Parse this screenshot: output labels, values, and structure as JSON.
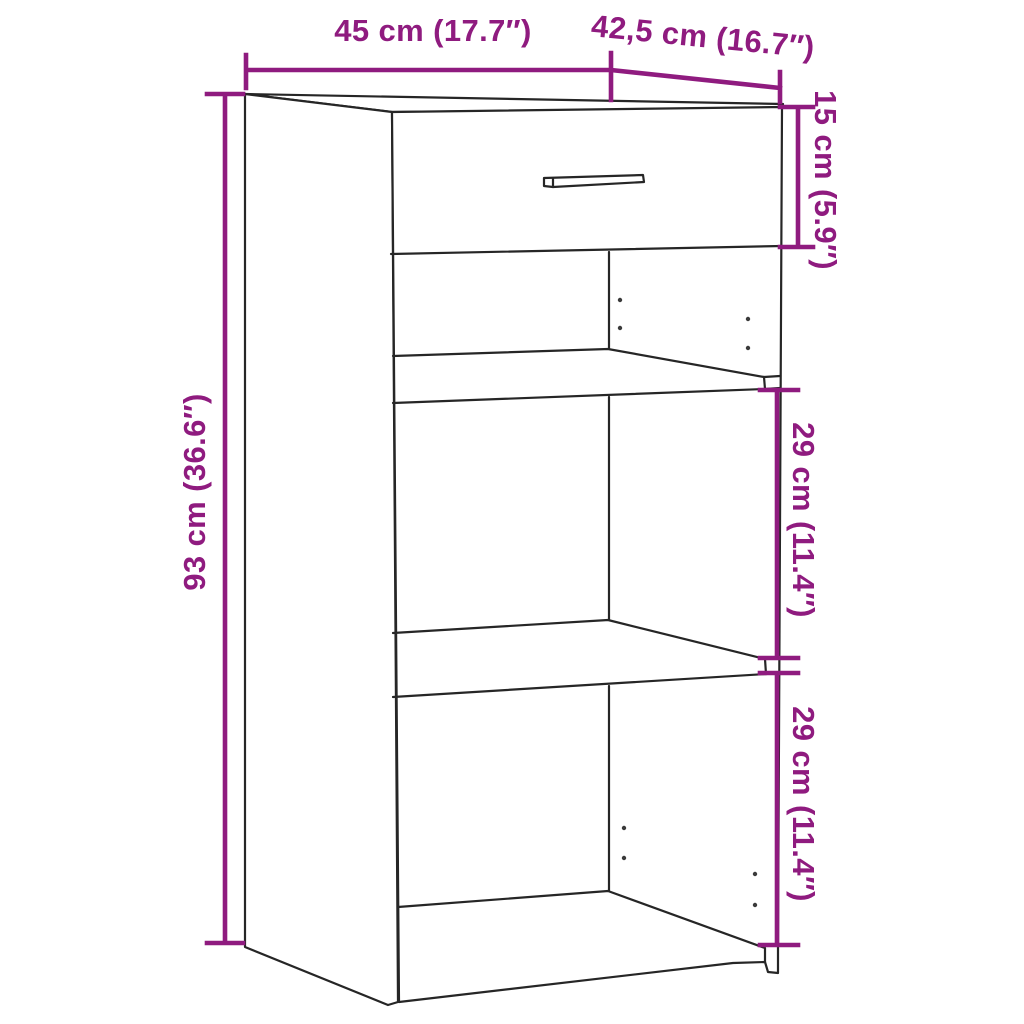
{
  "diagram": {
    "kind": "furniture dimension line drawing",
    "object": "sideboard with one drawer, two shelves and open compartments"
  },
  "colors": {
    "dimension_accent": "#8f1b7f",
    "line": "#262626",
    "background": "#ffffff"
  },
  "dimensions": {
    "width": {
      "label": "45 cm (17.7″)",
      "cm": 45
    },
    "depth": {
      "label": "42,5 cm (16.7″)",
      "cm": 42.5
    },
    "drawer_height": {
      "label": "15 cm (5.9″)",
      "cm": 15
    },
    "total_height": {
      "label": "93 cm (36.6″)",
      "cm": 93
    },
    "upper_shelf_gap": {
      "label": "29 cm (11.4″)",
      "cm": 29
    },
    "lower_shelf_gap": {
      "label": "29 cm (11.4″)",
      "cm": 29
    }
  }
}
